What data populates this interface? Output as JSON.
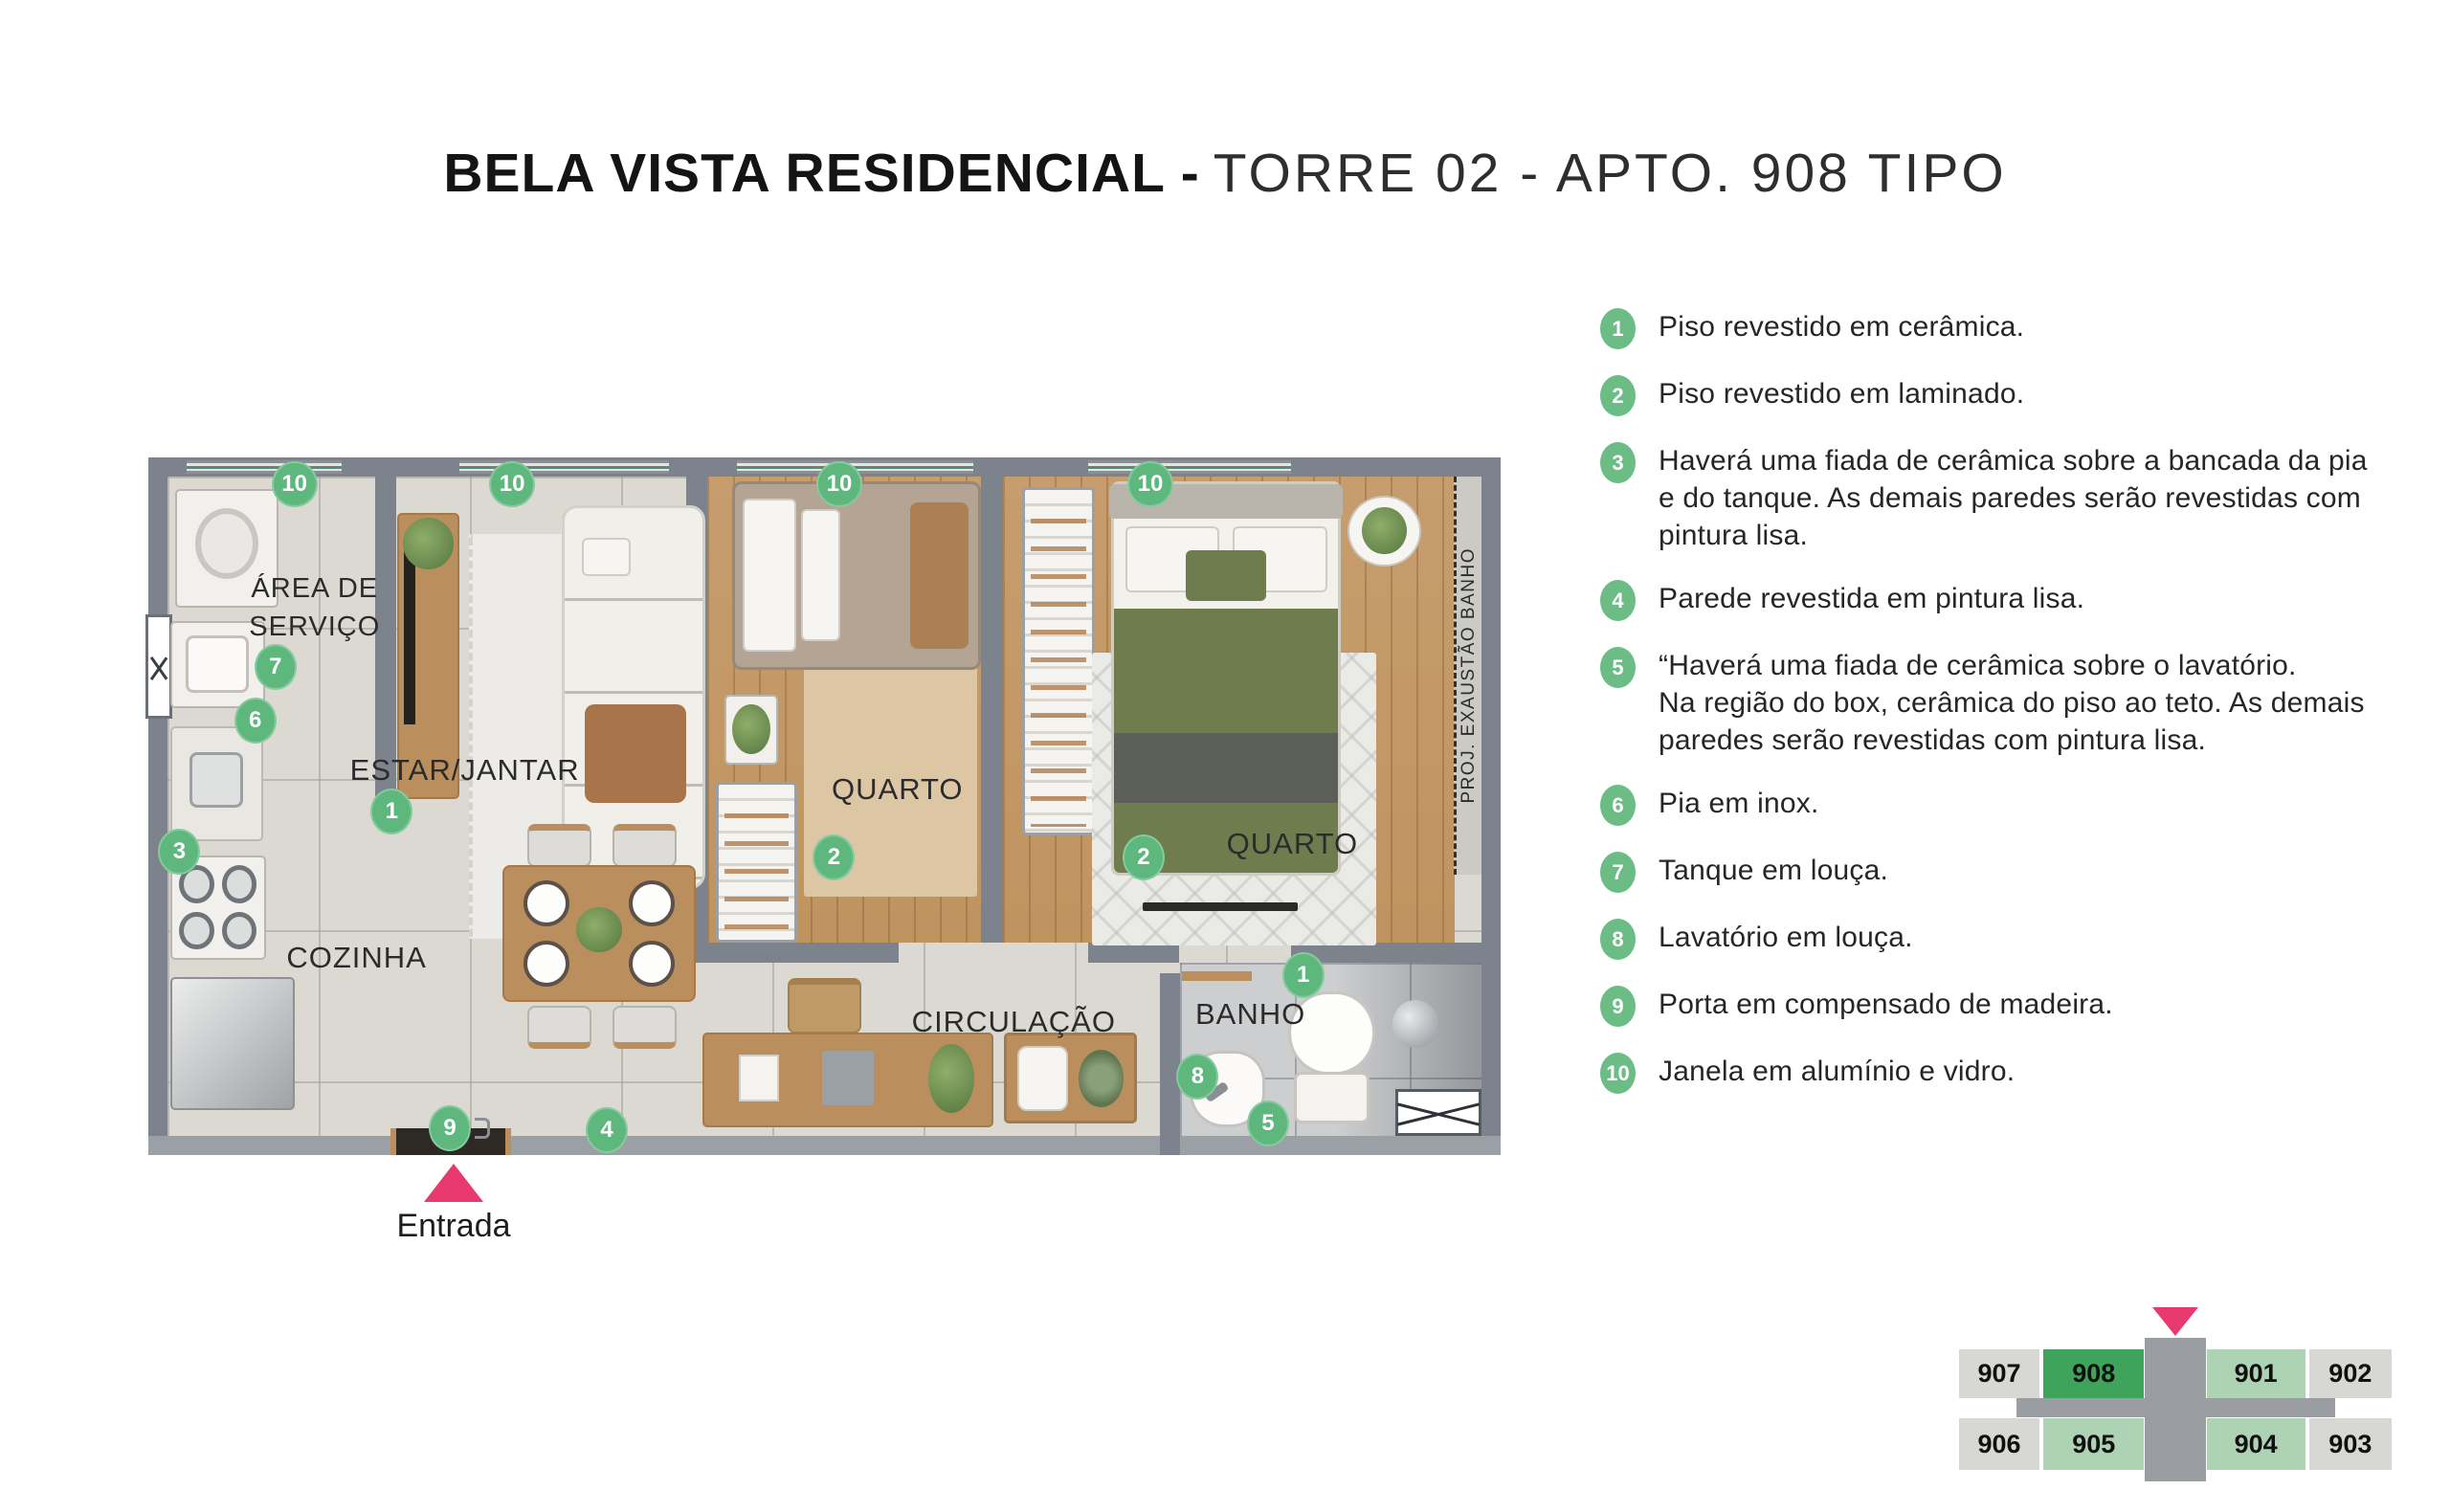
{
  "title": {
    "main": "BELA VISTA RESIDENCIAL -",
    "sub": "TORRE  02 - APTO. 908 TIPO"
  },
  "plan": {
    "rooms": {
      "area_servico": "ÁREA DE\nSERVIÇO",
      "estar": "ESTAR/JANTAR",
      "cozinha": "COZINHA",
      "quarto1": "QUARTO",
      "quarto2": "QUARTO",
      "circulacao": "CIRCULAÇÃO",
      "banho": "BANHO",
      "shaft": "PROJ. EXAUSTÃO BANHO"
    },
    "entrance_label": "Entrada",
    "markers": [
      {
        "num": "10"
      },
      {
        "num": "10"
      },
      {
        "num": "10"
      },
      {
        "num": "10"
      },
      {
        "num": "7"
      },
      {
        "num": "6"
      },
      {
        "num": "3"
      },
      {
        "num": "1"
      },
      {
        "num": "2"
      },
      {
        "num": "2"
      },
      {
        "num": "9"
      },
      {
        "num": "4"
      },
      {
        "num": "8"
      },
      {
        "num": "5"
      },
      {
        "num": "1"
      }
    ]
  },
  "legend": {
    "items": [
      {
        "num": "1",
        "text": "Piso revestido em cerâmica."
      },
      {
        "num": "2",
        "text": "Piso revestido em laminado."
      },
      {
        "num": "3",
        "text": "Haverá uma fiada de cerâmica sobre a bancada da pia\ne do tanque. As demais paredes serão revestidas com\npintura lisa."
      },
      {
        "num": "4",
        "text": "Parede revestida em pintura lisa."
      },
      {
        "num": "5",
        "text": "“Haverá uma fiada de cerâmica sobre o lavatório.\nNa região do box, cerâmica do piso ao teto. As demais\nparedes serão revestidas com pintura lisa."
      },
      {
        "num": "6",
        "text": "Pia em inox."
      },
      {
        "num": "7",
        "text": "Tanque em louça."
      },
      {
        "num": "8",
        "text": "Lavatório em louça."
      },
      {
        "num": "9",
        "text": "Porta em compensado de madeira."
      },
      {
        "num": "10",
        "text": "Janela em alumínio e vidro."
      }
    ]
  },
  "minimap": {
    "units": [
      {
        "label": "907",
        "variant": "gray"
      },
      {
        "label": "908",
        "variant": "current"
      },
      {
        "label": "901",
        "variant": "green"
      },
      {
        "label": "902",
        "variant": "gray"
      },
      {
        "label": "906",
        "variant": "gray"
      },
      {
        "label": "905",
        "variant": "green"
      },
      {
        "label": "904",
        "variant": "green"
      },
      {
        "label": "903",
        "variant": "gray"
      }
    ]
  },
  "colors": {
    "accent_green": "#5eb87d",
    "highlight_green": "#3fa45b",
    "light_green": "#aed3b4",
    "pink": "#e83a70",
    "wall_gray": "#7d838c"
  }
}
